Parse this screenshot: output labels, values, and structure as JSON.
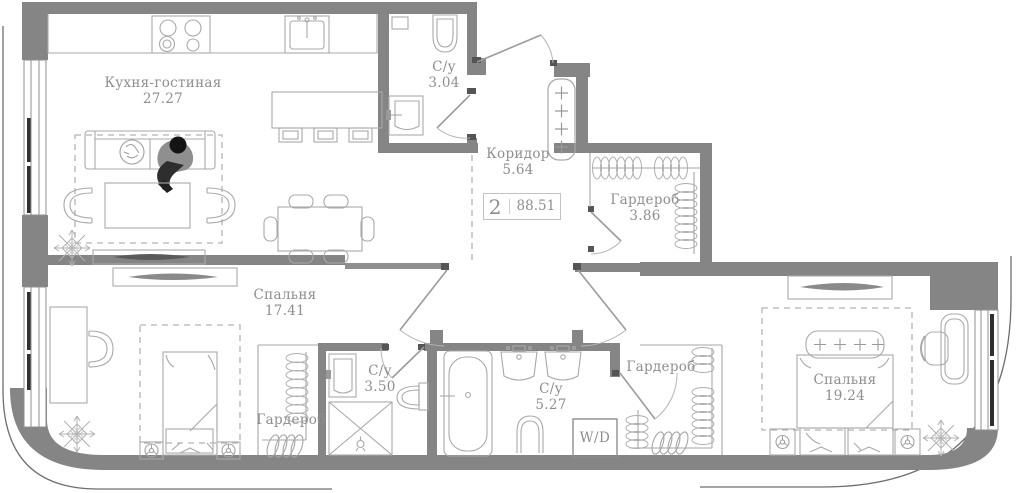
{
  "plan": {
    "type": "apartment-floor-plan",
    "badge": {
      "rooms_count": "2",
      "total_area": "88.51"
    },
    "rooms": [
      {
        "id": "kitchen-living",
        "label": "Кухня-гостиная",
        "area": "27.27"
      },
      {
        "id": "bathroom-top",
        "label": "С/у",
        "area": "3.04"
      },
      {
        "id": "corridor",
        "label": "Коридор",
        "area": "5.64"
      },
      {
        "id": "wardrobe-top",
        "label": "Гардероб",
        "area": "3.86"
      },
      {
        "id": "bedroom-1",
        "label": "Спальня",
        "area": "17.41"
      },
      {
        "id": "bathroom-mid",
        "label": "С/у",
        "area": "3.50"
      },
      {
        "id": "wardrobe-left",
        "label": "Гардероб",
        "area": ""
      },
      {
        "id": "bathroom-main",
        "label": "С/у",
        "area": "5.27"
      },
      {
        "id": "wardrobe-right",
        "label": "Гардероб",
        "area": ""
      },
      {
        "id": "bedroom-2",
        "label": "Спальня",
        "area": "19.24"
      }
    ],
    "appliances": {
      "washer_dryer": "W/D"
    },
    "colors": {
      "wall": "#858585",
      "furniture_line": "#a9a9a9",
      "text": "#8e8e8e",
      "dark_accent": "#4f4f4f"
    }
  }
}
